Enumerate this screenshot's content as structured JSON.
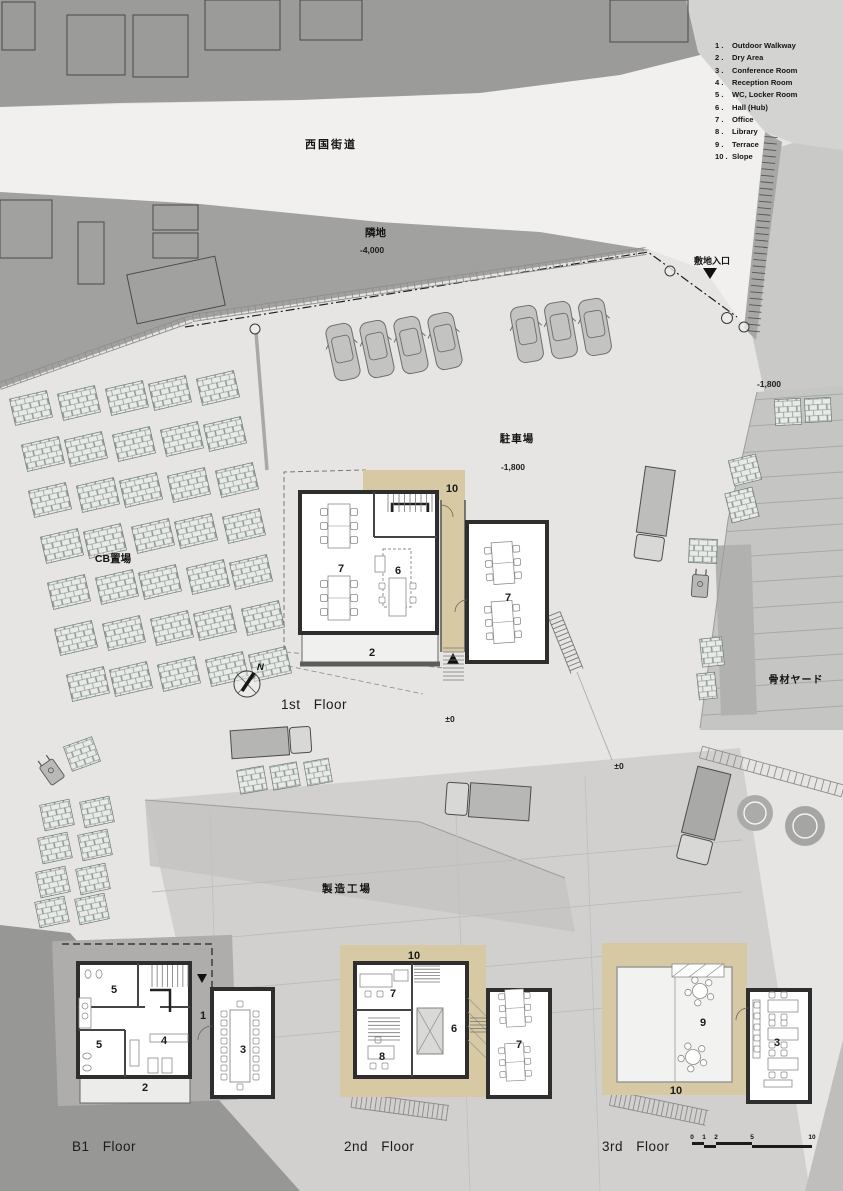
{
  "legend": {
    "items": [
      {
        "num": "1 .",
        "label": "Outdoor Walkway"
      },
      {
        "num": "2 .",
        "label": "Dry Area"
      },
      {
        "num": "3 .",
        "label": "Conference Room"
      },
      {
        "num": "4 .",
        "label": "Reception Room"
      },
      {
        "num": "5 .",
        "label": "WC, Locker Room"
      },
      {
        "num": "6 .",
        "label": "Hall (Hub)"
      },
      {
        "num": "7 .",
        "label": "Office"
      },
      {
        "num": "8 .",
        "label": "Library"
      },
      {
        "num": "9 .",
        "label": "Terrace"
      },
      {
        "num": "10 .",
        "label": "Slope"
      }
    ]
  },
  "site": {
    "road_name": "西国街道",
    "adjacent_lot": "隣地",
    "adjacent_level": "-4,000",
    "site_entrance": "敷地入口",
    "level_east": "-1,800",
    "parking": "駐車場",
    "parking_level": "-1,800",
    "cb_yard": "CB置場",
    "aggregate_yard": "骨材ヤード",
    "factory": "製造工場",
    "level_zero_1": "±0",
    "level_zero_2": "±0",
    "north_label": "N"
  },
  "floors": {
    "first": {
      "label": "1st Floor",
      "rooms": [
        "10",
        "7",
        "6",
        "7",
        "2"
      ]
    },
    "b1": {
      "label": "B1 Floor",
      "rooms": [
        "5",
        "1",
        "5",
        "4",
        "2",
        "3"
      ]
    },
    "second": {
      "label": "2nd Floor",
      "rooms": [
        "10",
        "7",
        "6",
        "8",
        "7"
      ]
    },
    "third": {
      "label": "3rd Floor",
      "rooms": [
        "9",
        "10",
        "3"
      ]
    }
  },
  "scale_bar": {
    "ticks": [
      "0",
      "1",
      "2",
      "5",
      "10"
    ]
  },
  "colors": {
    "slope_tan": "#d6c9a3",
    "dark_area": "#9b9b9a",
    "road": "#f1f0ee"
  }
}
